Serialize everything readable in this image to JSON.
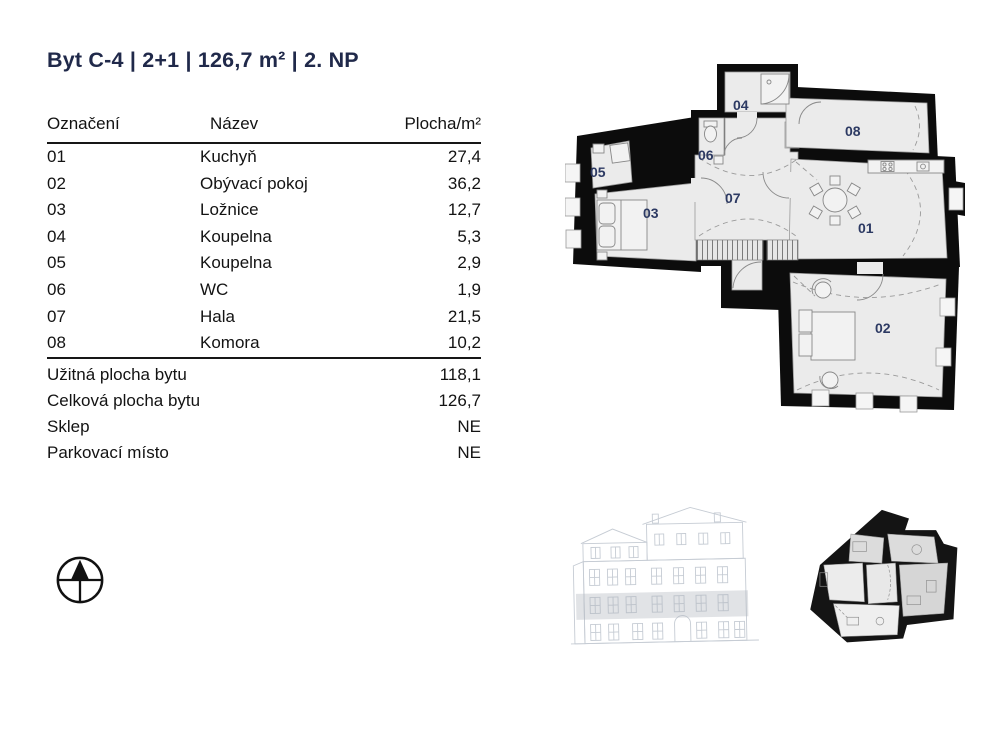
{
  "header": {
    "title": "Byt C-4 | 2+1 | 126,7 m² | 2. NP"
  },
  "table": {
    "columns": {
      "designation": "Označení",
      "name": "Název",
      "area": "Plocha/m²"
    },
    "rows": [
      {
        "code": "01",
        "name": "Kuchyň",
        "area": "27,4"
      },
      {
        "code": "02",
        "name": "Obývací pokoj",
        "area": "36,2"
      },
      {
        "code": "03",
        "name": "Ložnice",
        "area": "12,7"
      },
      {
        "code": "04",
        "name": "Koupelna",
        "area": "5,3"
      },
      {
        "code": "05",
        "name": "Koupelna",
        "area": "2,9"
      },
      {
        "code": "06",
        "name": "WC",
        "area": "1,9"
      },
      {
        "code": "07",
        "name": "Hala",
        "area": "21,5"
      },
      {
        "code": "08",
        "name": "Komora",
        "area": "10,2"
      }
    ],
    "summary": [
      {
        "label": "Užitná plocha bytu",
        "value": "118,1"
      },
      {
        "label": "Celková plocha bytu",
        "value": "126,7"
      },
      {
        "label": "Sklep",
        "value": "NE"
      },
      {
        "label": "Parkovací místo",
        "value": "NE"
      }
    ]
  },
  "floorplan": {
    "rooms": [
      {
        "number": "01"
      },
      {
        "number": "02"
      },
      {
        "number": "03"
      },
      {
        "number": "04"
      },
      {
        "number": "05"
      },
      {
        "number": "06"
      },
      {
        "number": "07"
      },
      {
        "number": "08"
      }
    ]
  },
  "colors": {
    "title_text": "#20294a",
    "table_text": "#131313",
    "room_label": "#2d3a63",
    "wall": "#0c0c0c",
    "floor_fill": "#ebebeb",
    "elevation_line": "#c6ccd4"
  }
}
